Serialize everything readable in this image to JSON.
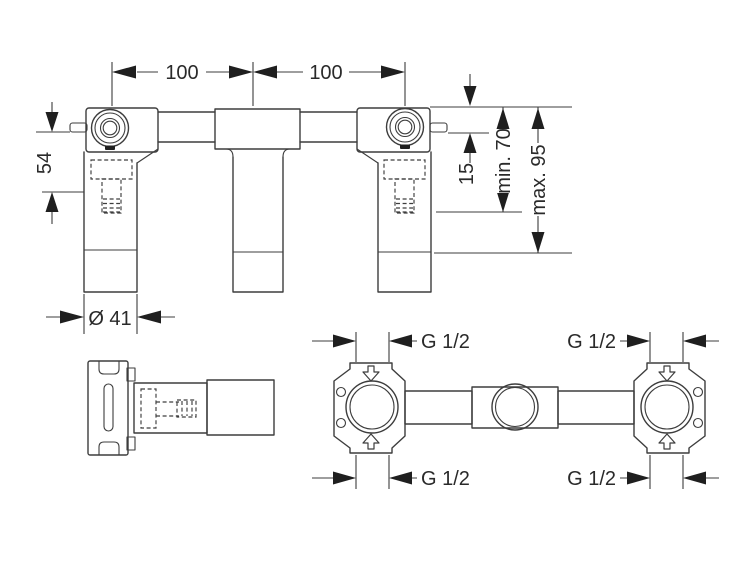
{
  "drawing_type": "technical dimension drawing, concealed basin mixer basic set, three views",
  "front_view": {
    "dim_left_spacing": "100",
    "dim_right_spacing": "100",
    "dim_height": "54",
    "dim_pin_offset": "15",
    "dim_min_depth": "min. 70",
    "dim_max_depth": "max. 95",
    "dim_leg_diameter": "Ø 41"
  },
  "plan_view": {
    "thread_top_left": "G 1/2",
    "thread_top_right": "G 1/2",
    "thread_bottom_left": "G 1/2",
    "thread_bottom_right": "G 1/2"
  },
  "colors": {
    "line": "#3d3d3d",
    "arrow": "#1f1f1f",
    "text": "#2a2a2a",
    "background": "#ffffff"
  }
}
